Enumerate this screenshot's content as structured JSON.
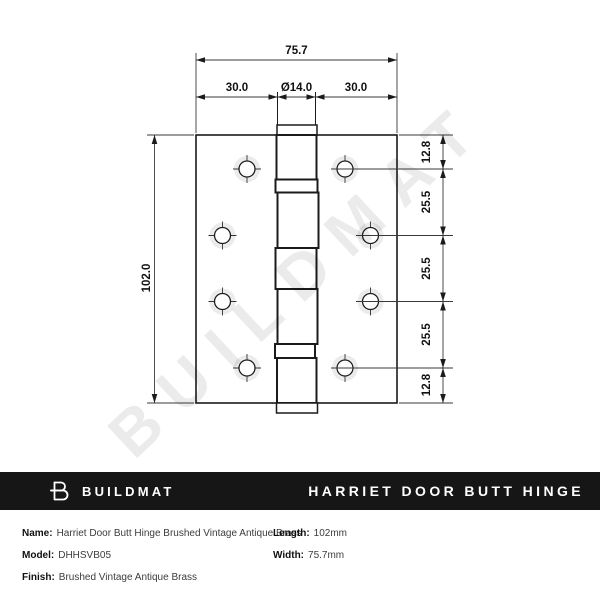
{
  "watermark": {
    "text": "BUILDMAT"
  },
  "drawing": {
    "dims": {
      "overall_width": "75.7",
      "left_span": "30.0",
      "pin_diameter": "Ø14.0",
      "right_span": "30.0",
      "height": "102.0",
      "right_chain": [
        "12.8",
        "25.5",
        "25.5",
        "25.5",
        "12.8"
      ]
    }
  },
  "footer": {
    "brand": "BUILDMAT",
    "product_title": "HARRIET DOOR BUTT HINGE",
    "colors": {
      "bar_bg": "#161616",
      "bar_text": "#ffffff"
    },
    "specs": {
      "left": [
        {
          "label": "Name:",
          "value": "Harriet Door Butt Hinge Brushed Vintage Antique Brass"
        },
        {
          "label": "Model:",
          "value": "DHHSVB05"
        },
        {
          "label": "Finish:",
          "value": "Brushed Vintage Antique Brass"
        }
      ],
      "right": [
        {
          "label": "Length:",
          "value": "102mm"
        },
        {
          "label": "Width:",
          "value": "75.7mm"
        }
      ]
    }
  }
}
